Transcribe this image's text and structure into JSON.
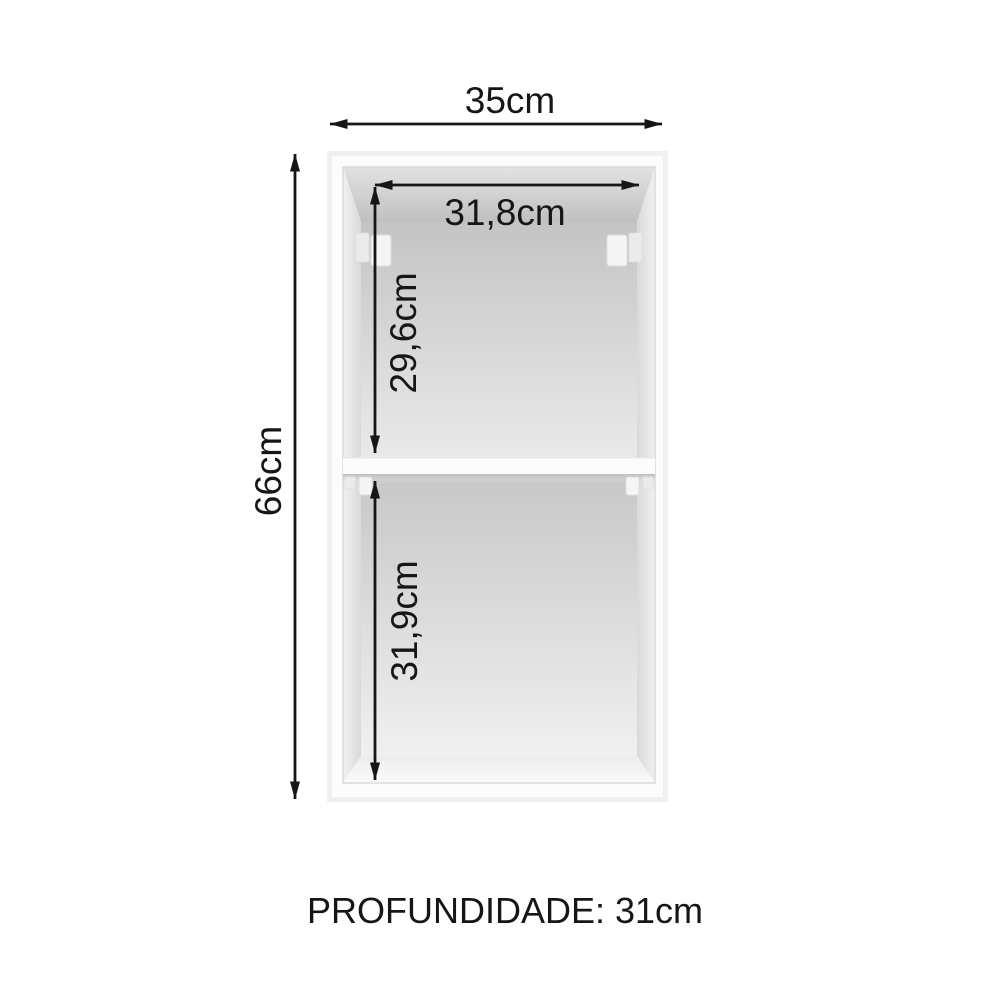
{
  "diagram": {
    "subject": "wall-cabinet-dimension-diagram",
    "dimensions": {
      "width": "35cm",
      "inner_width": "31,8cm",
      "upper_height": "29,6cm",
      "total_height": "66cm",
      "lower_height": "31,9cm"
    },
    "depth_label": "PROFUNDIDADE: 31cm",
    "colors": {
      "background": "#ffffff",
      "dimension_line": "#161616",
      "cabinet_edge": "#f0f0f0",
      "cabinet_face": "#fcfcfc",
      "interior_dark": "#c5c5c5",
      "interior_light": "#f0f0f0"
    }
  }
}
